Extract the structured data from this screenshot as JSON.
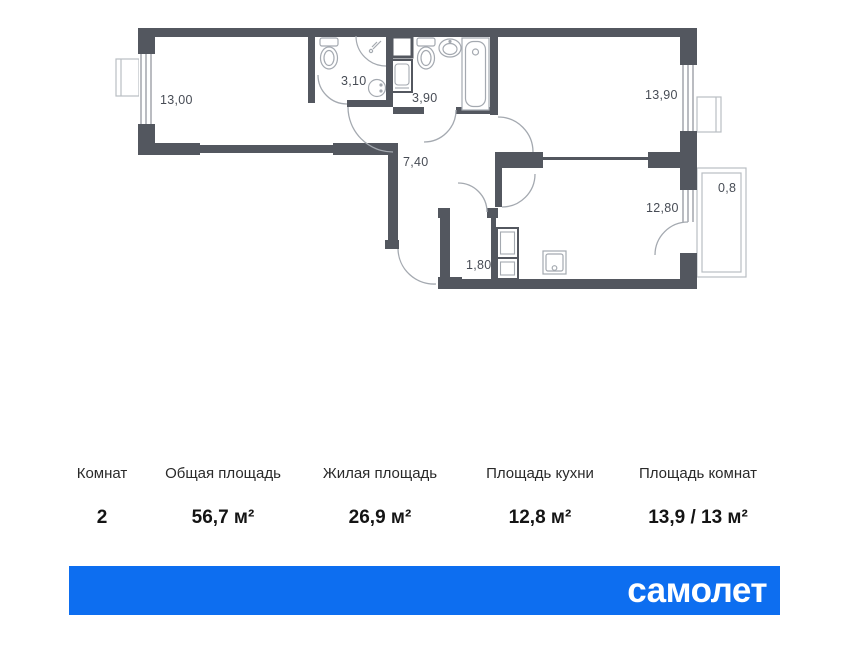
{
  "plan": {
    "wall_color": "#53575f",
    "fixture_color": "#a4a9b0",
    "outline_color": "#b9bdc3",
    "rooms": [
      {
        "name": "room-1",
        "area": "13,00"
      },
      {
        "name": "bathroom-1",
        "area": "3,10"
      },
      {
        "name": "bathroom-2",
        "area": "3,90"
      },
      {
        "name": "hallway",
        "area": "7,40"
      },
      {
        "name": "room-2",
        "area": "13,90"
      },
      {
        "name": "kitchen",
        "area": "12,80"
      },
      {
        "name": "storage",
        "area": "1,80"
      },
      {
        "name": "balcony",
        "area": "0,8"
      }
    ]
  },
  "summary": {
    "columns": [
      {
        "label": "Комнат",
        "value": "2"
      },
      {
        "label": "Общая площадь",
        "value": "56,7 м²"
      },
      {
        "label": "Жилая площадь",
        "value": "26,9 м²"
      },
      {
        "label": "Площадь кухни",
        "value": "12,8 м²"
      },
      {
        "label": "Площадь комнат",
        "value": "13,9 / 13 м²"
      }
    ]
  },
  "footer": {
    "brand": "самолет",
    "background": "#0d6ef0"
  }
}
